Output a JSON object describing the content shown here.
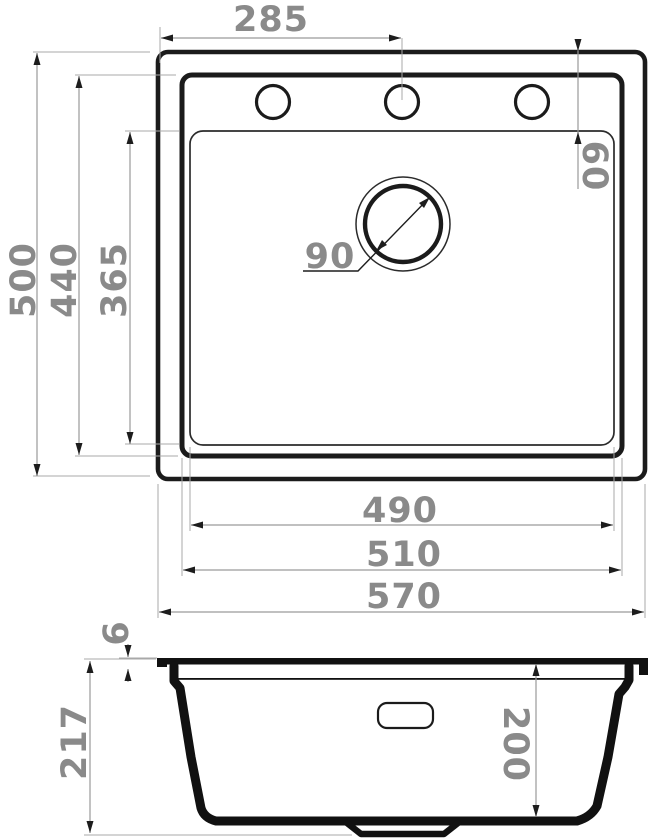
{
  "drawing": {
    "title": "Kitchen sink dimensional drawing, top view and side section",
    "colors": {
      "line": "#1b1b1b",
      "dimension_line": "#9a9a9a",
      "dimension_text": "#8a8a8a",
      "background": "#ffffff"
    },
    "top_view": {
      "edge_to_faucet_center": "285",
      "faucet_offset_from_back": "60",
      "outer_depth": "500",
      "bowl_depth": "440",
      "inner_bowl_depth": "365",
      "drain_diameter": "90",
      "inner_bowl_width": "490",
      "bowl_width": "510",
      "outer_width": "570"
    },
    "side_view": {
      "rim_thickness": "6",
      "overall_height": "217",
      "bowl_inner_depth": "200"
    }
  }
}
